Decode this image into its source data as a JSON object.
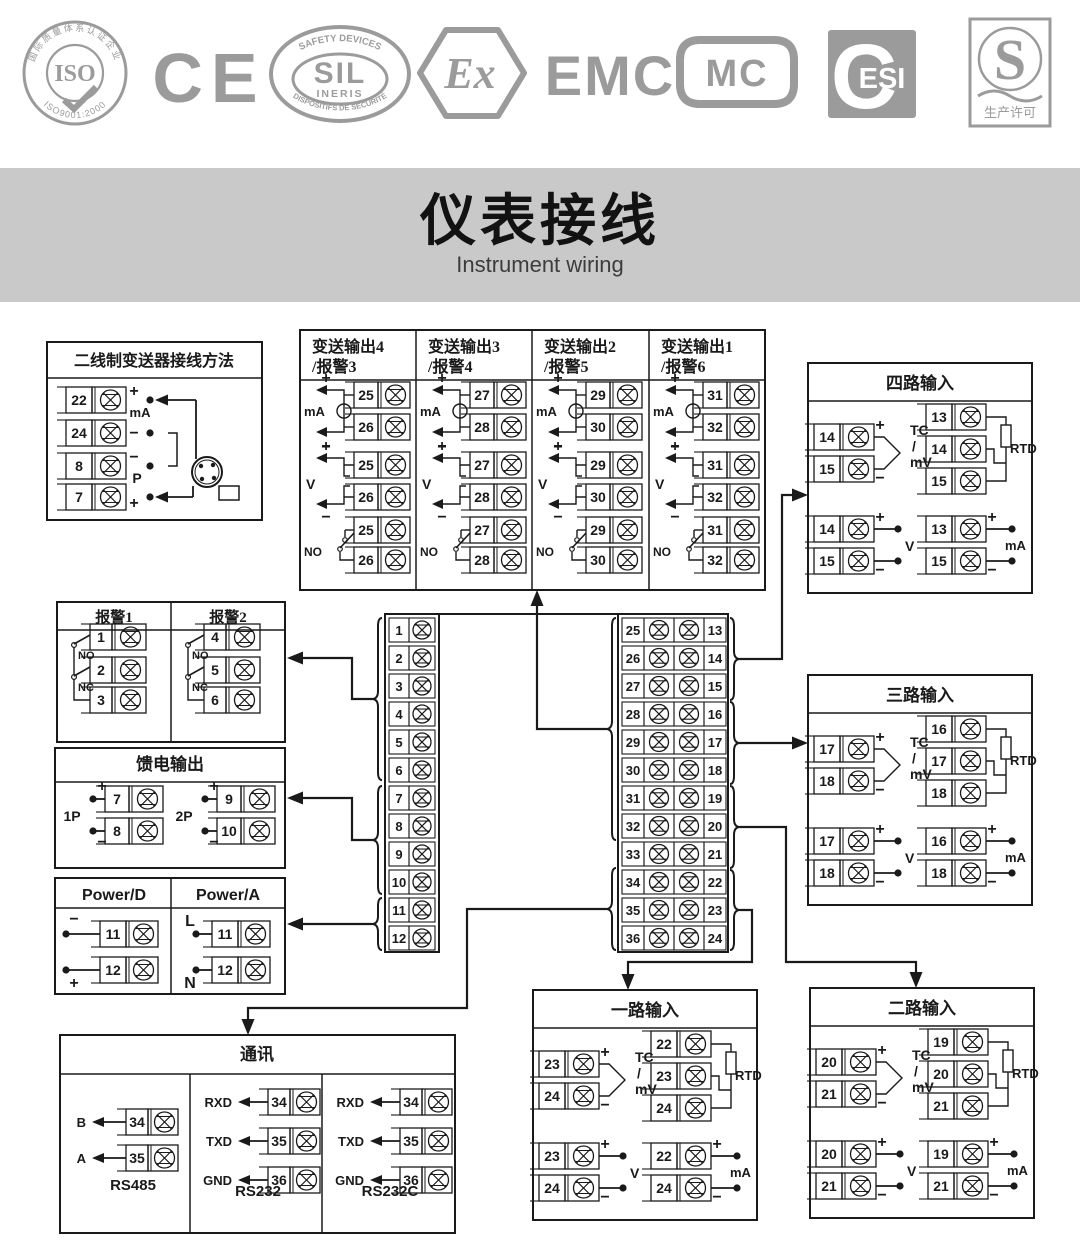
{
  "logos": {
    "iso": {
      "ring_text": "国际质量体系认证企业",
      "center": "ISO",
      "bottom_text": "ISO9001:2000"
    },
    "ce": {
      "text": "CE"
    },
    "sil": {
      "arc_top": "SAFETY DEVICES",
      "center": "SIL",
      "sub": "INERIS",
      "arc_bottom": "DISPOSITIFS DE SÉCURITÉ"
    },
    "ex": {
      "text": "Ex"
    },
    "emc": {
      "text": "EMC"
    },
    "mc": {
      "text": "MC"
    },
    "esi": {
      "text": "ESI"
    },
    "license": {
      "letter": "S",
      "caption": "生产许可"
    }
  },
  "banner": {
    "title": "仪表接线",
    "subtitle": "Instrument wiring"
  },
  "colors": {
    "ink": "#1a1a1a",
    "logo_gray": "#9b9b9b",
    "banner_gray": "#c9c9c9"
  },
  "diagram": {
    "two_wire": {
      "title": "二线制变送器接线方法",
      "terminals": [
        "22",
        "24",
        "8",
        "7"
      ],
      "plus_top": "+",
      "ma": "mA",
      "minus_mid": "−",
      "minus_low": "−",
      "p": "P",
      "plus_bottom": "+"
    },
    "transmit": {
      "columns": [
        {
          "title1": "变送输出4",
          "title2": "/报警3",
          "top": "25",
          "bottom": "26"
        },
        {
          "title1": "变送输出3",
          "title2": "/报警4",
          "top": "27",
          "bottom": "28"
        },
        {
          "title1": "变送输出2",
          "title2": "/报警5",
          "top": "29",
          "bottom": "30"
        },
        {
          "title1": "变送输出1",
          "title2": "/报警6",
          "top": "31",
          "bottom": "32"
        }
      ],
      "ma": "mA",
      "v": "V",
      "no": "NO",
      "plus": "+",
      "minus": "−"
    },
    "inputs": [
      {
        "title": "四路输入",
        "tc": [
          "14",
          "15"
        ],
        "rtd": [
          "13",
          "14",
          "15"
        ],
        "volt": [
          "14",
          "15"
        ],
        "amp": [
          "13",
          "15"
        ]
      },
      {
        "title": "三路输入",
        "tc": [
          "17",
          "18"
        ],
        "rtd": [
          "16",
          "17",
          "18"
        ],
        "volt": [
          "17",
          "18"
        ],
        "amp": [
          "16",
          "18"
        ]
      },
      {
        "title": "一路输入",
        "tc": [
          "23",
          "24"
        ],
        "rtd": [
          "22",
          "23",
          "24"
        ],
        "volt": [
          "23",
          "24"
        ],
        "amp": [
          "22",
          "24"
        ]
      },
      {
        "title": "二路输入",
        "tc": [
          "20",
          "21"
        ],
        "rtd": [
          "19",
          "20",
          "21"
        ],
        "volt": [
          "20",
          "21"
        ],
        "amp": [
          "19",
          "21"
        ]
      }
    ],
    "input_labels": {
      "plus": "+",
      "minus": "−",
      "tc": "TC",
      "slash": "/",
      "mv": "mV",
      "rtd": "RTD",
      "volt": "V",
      "amp": "mA"
    },
    "alarm": {
      "columns": [
        {
          "title": "报警1",
          "terminals": [
            "1",
            "2",
            "3"
          ]
        },
        {
          "title": "报警2",
          "terminals": [
            "4",
            "5",
            "6"
          ]
        }
      ],
      "no": "NO",
      "nc": "NC"
    },
    "feed": {
      "title": "馈电输出",
      "groups": [
        {
          "label": "1P",
          "top": "7",
          "bottom": "8"
        },
        {
          "label": "2P",
          "top": "9",
          "bottom": "10"
        }
      ],
      "plus": "+",
      "minus": "−"
    },
    "power": {
      "columns": [
        {
          "title": "Power/D",
          "top_label": "−",
          "top": "11",
          "bottom": "12",
          "bottom_label": "+"
        },
        {
          "title": "Power/A",
          "top_label": "L",
          "top": "11",
          "bottom": "12",
          "bottom_label": "N"
        }
      ]
    },
    "comm": {
      "title": "通讯",
      "sections": [
        {
          "name": "RS485",
          "rows": [
            {
              "label": "B",
              "terminal": "34"
            },
            {
              "label": "A",
              "terminal": "35"
            }
          ]
        },
        {
          "name": "RS232",
          "rows": [
            {
              "label": "RXD",
              "terminal": "34"
            },
            {
              "label": "TXD",
              "terminal": "35"
            },
            {
              "label": "GND",
              "terminal": "36"
            }
          ]
        },
        {
          "name": "RS232C",
          "rows": [
            {
              "label": "RXD",
              "terminal": "34"
            },
            {
              "label": "TXD",
              "terminal": "35"
            },
            {
              "label": "GND",
              "terminal": "36"
            }
          ]
        }
      ]
    },
    "left_strip": [
      "1",
      "2",
      "3",
      "4",
      "5",
      "6",
      "7",
      "8",
      "9",
      "10",
      "11",
      "12"
    ],
    "right_strip_left": [
      "25",
      "26",
      "27",
      "28",
      "29",
      "30",
      "31",
      "32",
      "33",
      "34",
      "35",
      "36"
    ],
    "right_strip_right": [
      "13",
      "14",
      "15",
      "16",
      "17",
      "18",
      "19",
      "20",
      "21",
      "22",
      "23",
      "24"
    ]
  }
}
